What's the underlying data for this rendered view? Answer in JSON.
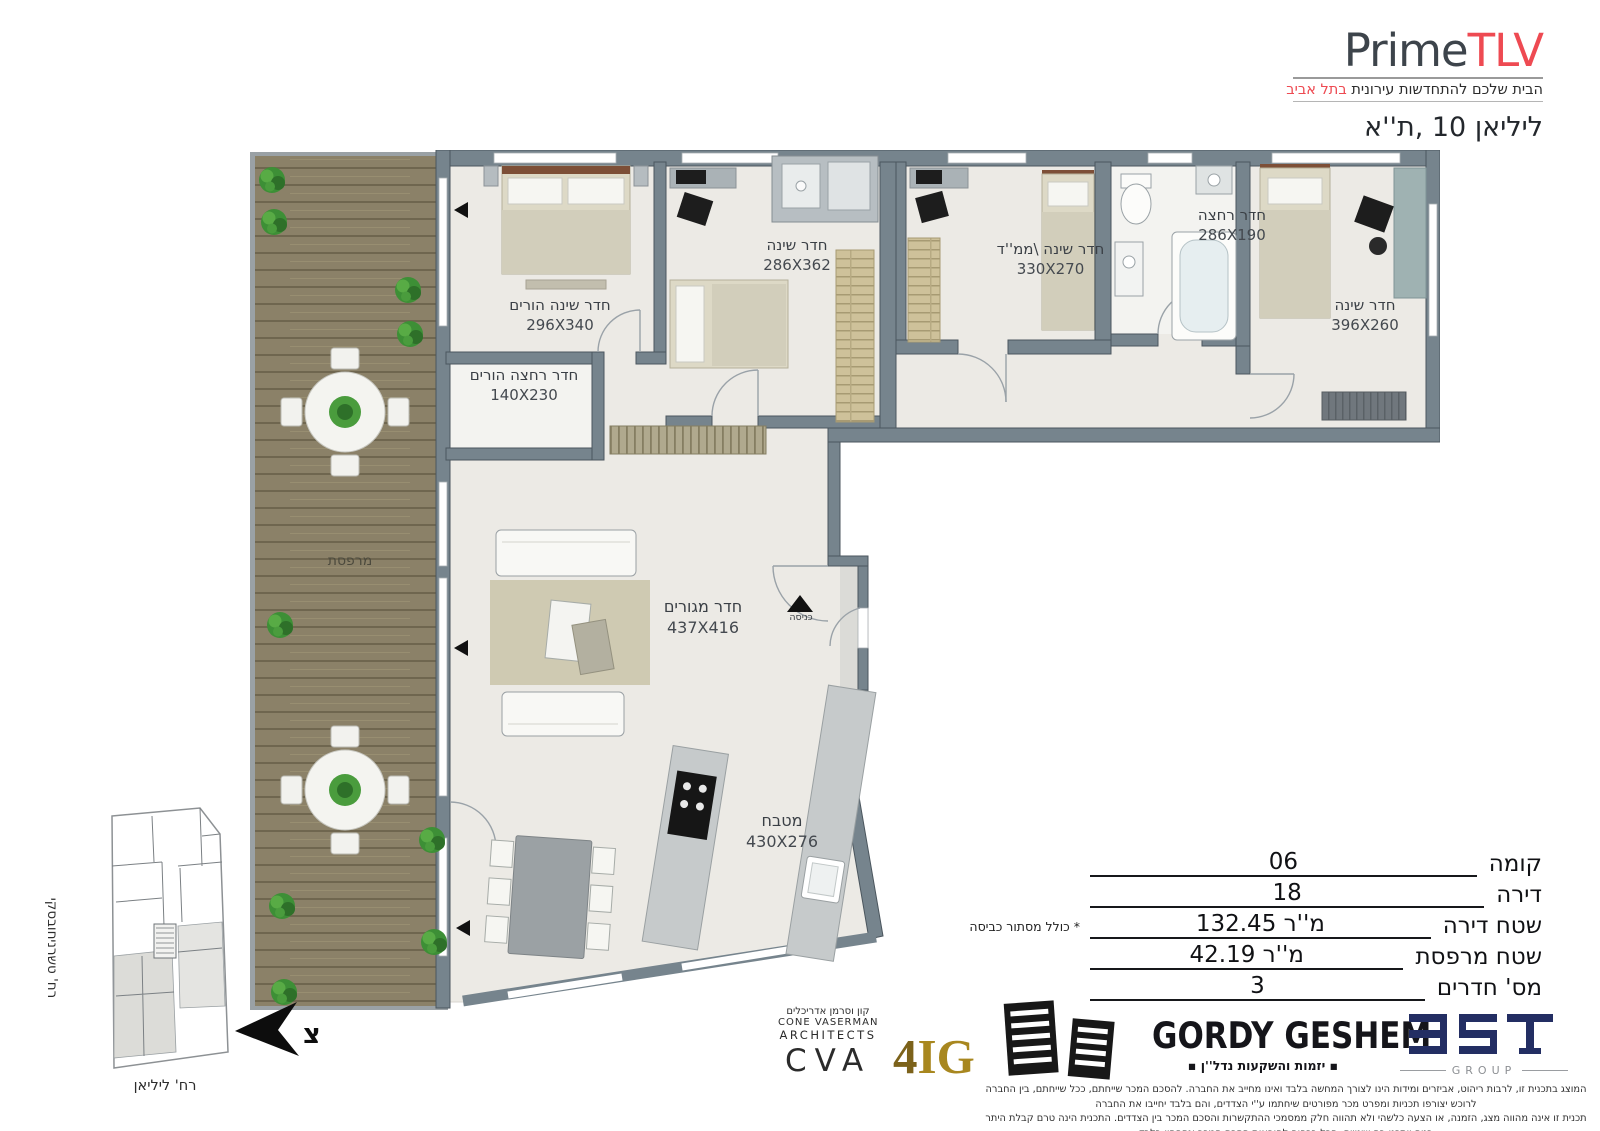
{
  "brand": {
    "logo_prime": "Prime",
    "logo_tlv": "TLV",
    "tagline": "הבית שלכם להתחדשות עירונית",
    "tagline_accent": "בתל אביב",
    "address": "ליליאן 10 ,ת''א",
    "accent_color": "#ee4a52"
  },
  "rooms": [
    {
      "name": "חדר שינה הורים",
      "dims": "296X340"
    },
    {
      "name": "חדר רחצה הורים",
      "dims": "140X230"
    },
    {
      "name": "חדר שינה",
      "dims": "286X362"
    },
    {
      "name": "חדר שינה \\ממ''ד",
      "dims": "330X270"
    },
    {
      "name": "חדר רחצה",
      "dims": "286X190"
    },
    {
      "name": "חדר שינה",
      "dims": "396X260"
    },
    {
      "name": "חדר מגורים",
      "dims": "437X416"
    },
    {
      "name": "מטבח",
      "dims": "430X276"
    },
    {
      "name": "מרפסת",
      "dims": ""
    },
    {
      "name": "כניסה",
      "dims": ""
    }
  ],
  "specs": {
    "rows": [
      {
        "label": "קומה",
        "value": "06"
      },
      {
        "label": "דירה",
        "value": "18"
      },
      {
        "label": "שטח דירה",
        "value": "132.45 מ''ר",
        "note": "* כולל מסתור כביסה"
      },
      {
        "label": "שטח מרפסת",
        "value": "42.19 מ''ר"
      },
      {
        "label": "מס' חדרים",
        "value": "3"
      }
    ]
  },
  "site_plan": {
    "street_side": "רח' טשרניחובסקי",
    "street_bottom": "רח' ליליאן",
    "north_letter": "צ"
  },
  "logos": {
    "cva": {
      "hebrew": "קון וסרמן אדריכלים",
      "line1": "CONE VASERMAN",
      "line2": "ARCHITECTS",
      "acronym": "CVA"
    },
    "fig": {
      "four": "4",
      "ig": "IG",
      "gold": "#a8871f"
    },
    "gordy": {
      "title": "GORDY GESHEM",
      "subtitle": "▪ יזמות והשקעות נדל''ן ▪"
    },
    "bst": {
      "subtitle": "GROUP",
      "navy": "#232e63"
    }
  },
  "disclaimer": {
    "line1": "המוצג בתכנית זו, לרבות ריהוט, אביזרים ומידות הינו לצורך המחשה בלבד ואינו מחייב את החברה. להסכם המכר שייחתם, ככל שייחתם, בין החברה לרוכש יצורפו תכניות ומפרט מכר מפורטים שיחתמו ע''י הצדדים, והם בלבד יחייבו את החברה",
    "line2": "תכנית זו אינה מהווה מצג, הזמנה, או הצעה כלשהי ולא תהווה חלק ממסמכי ההתקשרות והסכם המכר בין הצדדים. התכנית הינה טרם קבלת היתר בניה ויתכנו בה שינויים. הכל בכפוף להוראות הסכם המכר ונספחיו בלבד"
  }
}
